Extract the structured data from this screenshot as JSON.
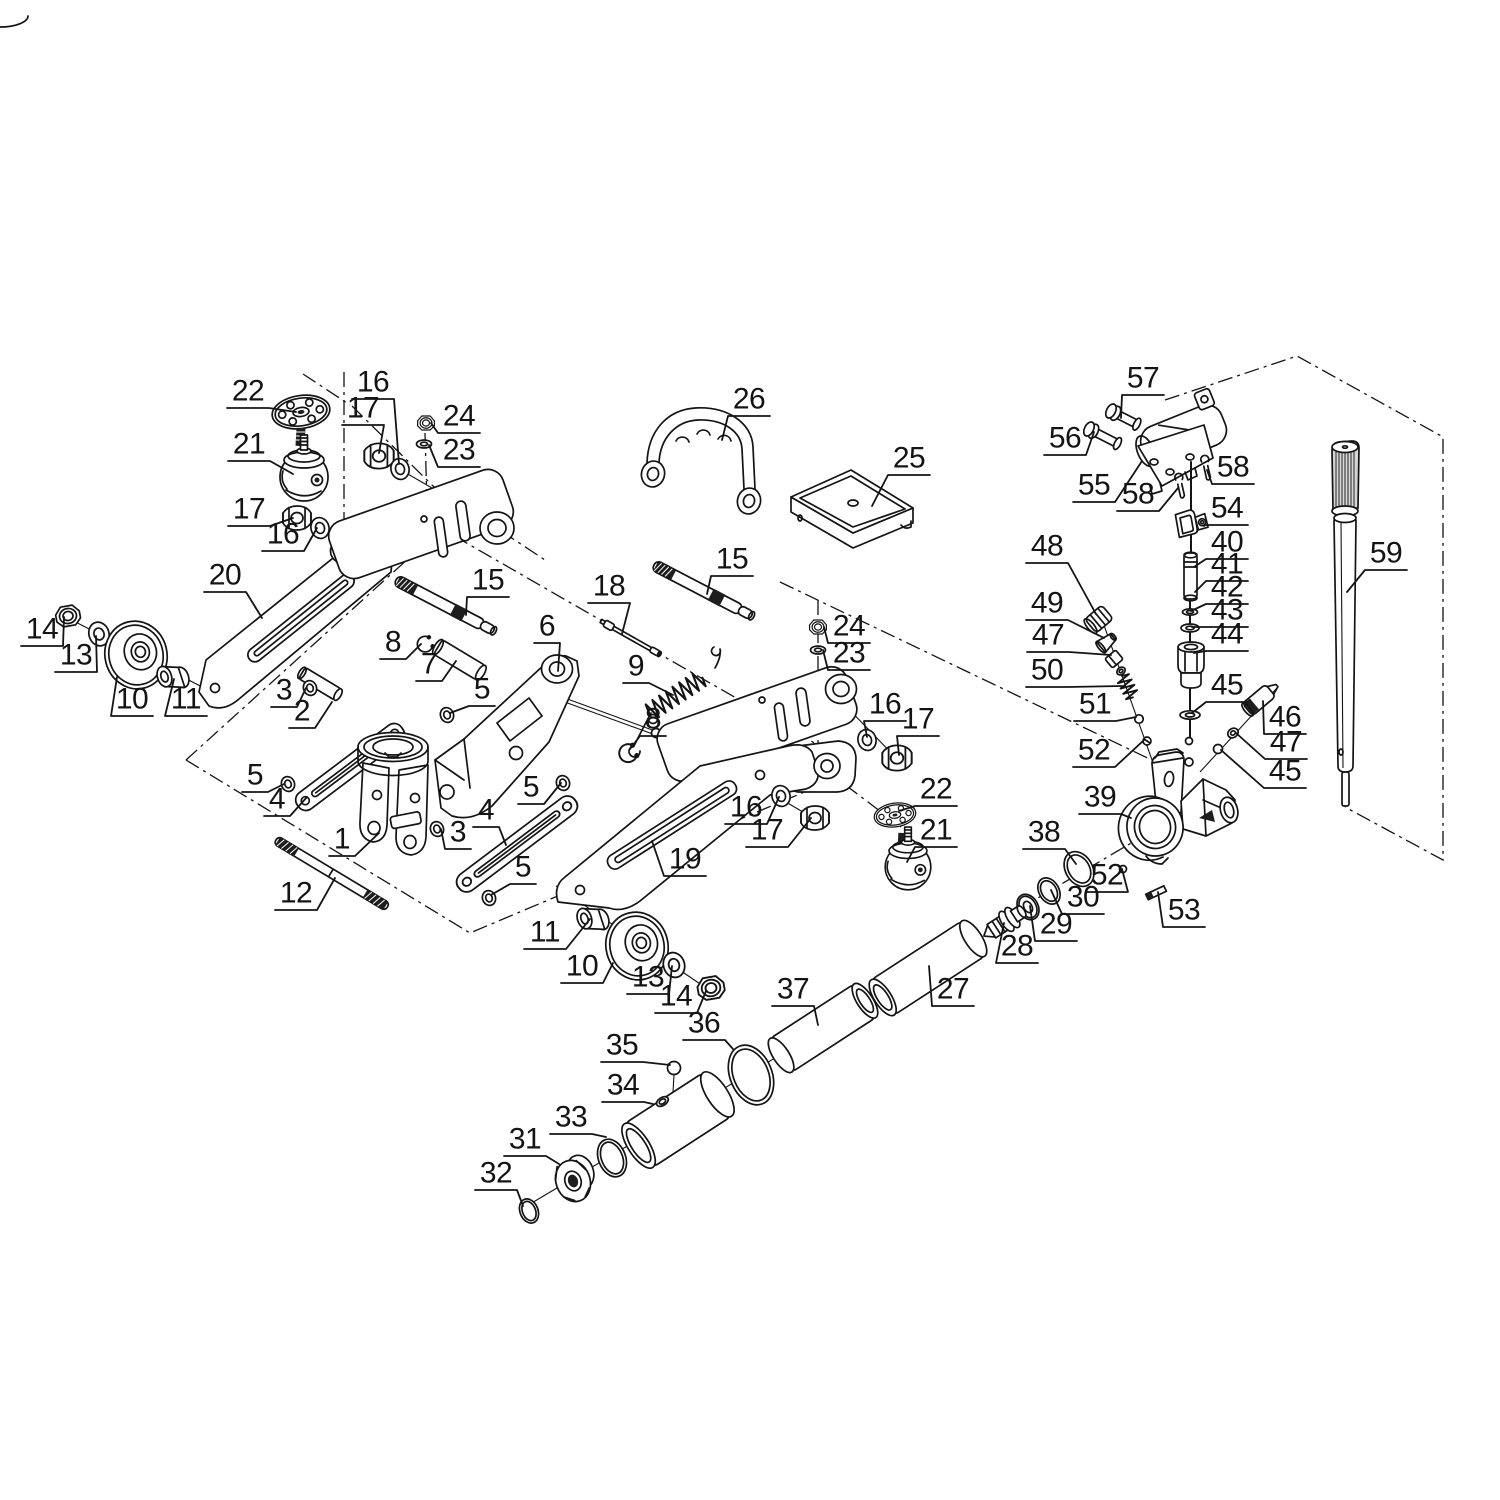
{
  "style": {
    "background": "#ffffff",
    "ink": "#141414"
  },
  "callouts": [
    {
      "label": "22",
      "x": 248,
      "y": 394,
      "tx": 296,
      "ty": 412
    },
    {
      "label": "21",
      "x": 249,
      "y": 447,
      "tx": 293,
      "ty": 474
    },
    {
      "label": "16",
      "x": 373,
      "y": 385,
      "tx": 399,
      "ty": 464
    },
    {
      "label": "17",
      "x": 363,
      "y": 411,
      "tx": 379,
      "ty": 453
    },
    {
      "label": "24",
      "x": 459,
      "y": 419,
      "tx": 431,
      "ty": 423
    },
    {
      "label": "23",
      "x": 459,
      "y": 453,
      "tx": 429,
      "ty": 445
    },
    {
      "label": "17",
      "x": 249,
      "y": 512,
      "tx": 293,
      "ty": 518
    },
    {
      "label": "16",
      "x": 283,
      "y": 537,
      "tx": 317,
      "ty": 528
    },
    {
      "label": "20",
      "x": 225,
      "y": 578,
      "tx": 262,
      "ty": 618
    },
    {
      "label": "15",
      "x": 488,
      "y": 583,
      "tx": 466,
      "ty": 615
    },
    {
      "label": "18",
      "x": 609,
      "y": 589,
      "tx": 622,
      "ty": 634
    },
    {
      "label": "15",
      "x": 732,
      "y": 562,
      "tx": 707,
      "ty": 594
    },
    {
      "label": "26",
      "x": 749,
      "y": 402,
      "tx": 722,
      "ty": 440
    },
    {
      "label": "25",
      "x": 909,
      "y": 461,
      "tx": 872,
      "ty": 506
    },
    {
      "label": "6",
      "x": 547,
      "y": 629,
      "tx": 558,
      "ty": 671
    },
    {
      "label": "8",
      "x": 393,
      "y": 645,
      "tx": 421,
      "ty": 644
    },
    {
      "label": "7",
      "x": 429,
      "y": 667,
      "tx": 456,
      "ty": 661
    },
    {
      "label": "5",
      "x": 482,
      "y": 692,
      "tx": 450,
      "ty": 713
    },
    {
      "label": "9",
      "x": 636,
      "y": 669,
      "tx": 673,
      "ty": 695
    },
    {
      "label": "3",
      "x": 284,
      "y": 693,
      "tx": 306,
      "ty": 688
    },
    {
      "label": "2",
      "x": 302,
      "y": 714,
      "tx": 332,
      "ty": 702
    },
    {
      "label": "14",
      "x": 42,
      "y": 632,
      "tx": 64,
      "ty": 617
    },
    {
      "label": "13",
      "x": 76,
      "y": 658,
      "tx": 96,
      "ty": 636
    },
    {
      "label": "10",
      "x": 132,
      "y": 702,
      "tx": 117,
      "ty": 677
    },
    {
      "label": "11",
      "x": 186,
      "y": 702,
      "tx": 174,
      "ty": 679
    },
    {
      "label": "5",
      "x": 255,
      "y": 778,
      "tx": 284,
      "ty": 784
    },
    {
      "label": "4",
      "x": 277,
      "y": 802,
      "tx": 307,
      "ty": 797
    },
    {
      "label": "1",
      "x": 342,
      "y": 842,
      "tx": 379,
      "ty": 833
    },
    {
      "label": "12",
      "x": 296,
      "y": 896,
      "tx": 335,
      "ty": 878
    },
    {
      "label": "8",
      "x": 653,
      "y": 722,
      "tx": 630,
      "ty": 749
    },
    {
      "label": "5",
      "x": 531,
      "y": 790,
      "tx": 561,
      "ty": 783
    },
    {
      "label": "4",
      "x": 486,
      "y": 813,
      "tx": 506,
      "ty": 845
    },
    {
      "label": "3",
      "x": 458,
      "y": 835,
      "tx": 441,
      "ty": 829
    },
    {
      "label": "5",
      "x": 523,
      "y": 870,
      "tx": 491,
      "ty": 895
    },
    {
      "label": "19",
      "x": 685,
      "y": 862,
      "tx": 652,
      "ty": 841
    },
    {
      "label": "16",
      "x": 746,
      "y": 810,
      "tx": 779,
      "ty": 797
    },
    {
      "label": "17",
      "x": 767,
      "y": 833,
      "tx": 811,
      "ty": 818
    },
    {
      "label": "24",
      "x": 849,
      "y": 629,
      "tx": 824,
      "ty": 627
    },
    {
      "label": "23",
      "x": 849,
      "y": 656,
      "tx": 823,
      "ty": 650
    },
    {
      "label": "16",
      "x": 885,
      "y": 707,
      "tx": 867,
      "ty": 737
    },
    {
      "label": "17",
      "x": 918,
      "y": 722,
      "tx": 899,
      "ty": 755
    },
    {
      "label": "22",
      "x": 936,
      "y": 792,
      "tx": 899,
      "ty": 811
    },
    {
      "label": "21",
      "x": 936,
      "y": 833,
      "tx": 907,
      "ty": 862
    },
    {
      "label": "57",
      "x": 1143,
      "y": 381,
      "tx": 1121,
      "ty": 418
    },
    {
      "label": "56",
      "x": 1065,
      "y": 441,
      "tx": 1094,
      "ty": 432
    },
    {
      "label": "55",
      "x": 1094,
      "y": 488,
      "tx": 1142,
      "ty": 461
    },
    {
      "label": "58",
      "x": 1138,
      "y": 497,
      "tx": 1178,
      "ty": 488
    },
    {
      "label": "58",
      "x": 1233,
      "y": 470,
      "tx": 1207,
      "ty": 470
    },
    {
      "label": "54",
      "x": 1227,
      "y": 511,
      "tx": 1204,
      "ty": 526
    },
    {
      "label": "40",
      "x": 1227,
      "y": 545,
      "tx": 1194,
      "ty": 567
    },
    {
      "label": "41",
      "x": 1227,
      "y": 567,
      "tx": 1195,
      "ty": 592
    },
    {
      "label": "42",
      "x": 1227,
      "y": 590,
      "tx": 1191,
      "ty": 611
    },
    {
      "label": "43",
      "x": 1227,
      "y": 613,
      "tx": 1192,
      "ty": 627
    },
    {
      "label": "44",
      "x": 1227,
      "y": 637,
      "tx": 1194,
      "ty": 653
    },
    {
      "label": "45",
      "x": 1227,
      "y": 688,
      "tx": 1192,
      "ty": 713
    },
    {
      "label": "46",
      "x": 1285,
      "y": 720,
      "tx": 1263,
      "ty": 701
    },
    {
      "label": "47",
      "x": 1286,
      "y": 745,
      "tx": 1236,
      "ty": 733
    },
    {
      "label": "45",
      "x": 1285,
      "y": 774,
      "tx": 1221,
      "ty": 750
    },
    {
      "label": "48",
      "x": 1047,
      "y": 549,
      "tx": 1096,
      "ty": 614
    },
    {
      "label": "49",
      "x": 1047,
      "y": 606,
      "tx": 1104,
      "ty": 638
    },
    {
      "label": "47",
      "x": 1048,
      "y": 638,
      "tx": 1111,
      "ty": 655
    },
    {
      "label": "50",
      "x": 1047,
      "y": 673,
      "tx": 1122,
      "ty": 686
    },
    {
      "label": "51",
      "x": 1095,
      "y": 707,
      "tx": 1136,
      "ty": 717
    },
    {
      "label": "52",
      "x": 1094,
      "y": 753,
      "tx": 1144,
      "ty": 740
    },
    {
      "label": "39",
      "x": 1100,
      "y": 800,
      "tx": 1131,
      "ty": 818
    },
    {
      "label": "38",
      "x": 1044,
      "y": 835,
      "tx": 1076,
      "ty": 864
    },
    {
      "label": "52",
      "x": 1107,
      "y": 878,
      "tx": 1122,
      "ty": 869
    },
    {
      "label": "30",
      "x": 1083,
      "y": 900,
      "tx": 1051,
      "ty": 890
    },
    {
      "label": "29",
      "x": 1056,
      "y": 927,
      "tx": 1030,
      "ty": 906
    },
    {
      "label": "28",
      "x": 1017,
      "y": 949,
      "tx": 1004,
      "ty": 923
    },
    {
      "label": "53",
      "x": 1184,
      "y": 913,
      "tx": 1158,
      "ty": 892
    },
    {
      "label": "27",
      "x": 953,
      "y": 992,
      "tx": 929,
      "ty": 966
    },
    {
      "label": "37",
      "x": 793,
      "y": 992,
      "tx": 818,
      "ty": 1025
    },
    {
      "label": "36",
      "x": 704,
      "y": 1026,
      "tx": 733,
      "ty": 1049
    },
    {
      "label": "35",
      "x": 622,
      "y": 1048,
      "tx": 670,
      "ty": 1065
    },
    {
      "label": "34",
      "x": 623,
      "y": 1088,
      "tx": 653,
      "ty": 1104
    },
    {
      "label": "33",
      "x": 571,
      "y": 1120,
      "tx": 606,
      "ty": 1137
    },
    {
      "label": "31",
      "x": 525,
      "y": 1142,
      "tx": 559,
      "ty": 1164
    },
    {
      "label": "32",
      "x": 496,
      "y": 1176,
      "tx": 523,
      "ty": 1206
    },
    {
      "label": "11",
      "x": 545,
      "y": 935,
      "tx": 590,
      "ty": 919
    },
    {
      "label": "10",
      "x": 582,
      "y": 969,
      "tx": 613,
      "ty": 963
    },
    {
      "label": "13",
      "x": 648,
      "y": 980,
      "tx": 672,
      "ty": 966
    },
    {
      "label": "14",
      "x": 676,
      "y": 999,
      "tx": 706,
      "ty": 991
    },
    {
      "label": "59",
      "x": 1386,
      "y": 556,
      "tx": 1347,
      "ty": 592
    }
  ]
}
